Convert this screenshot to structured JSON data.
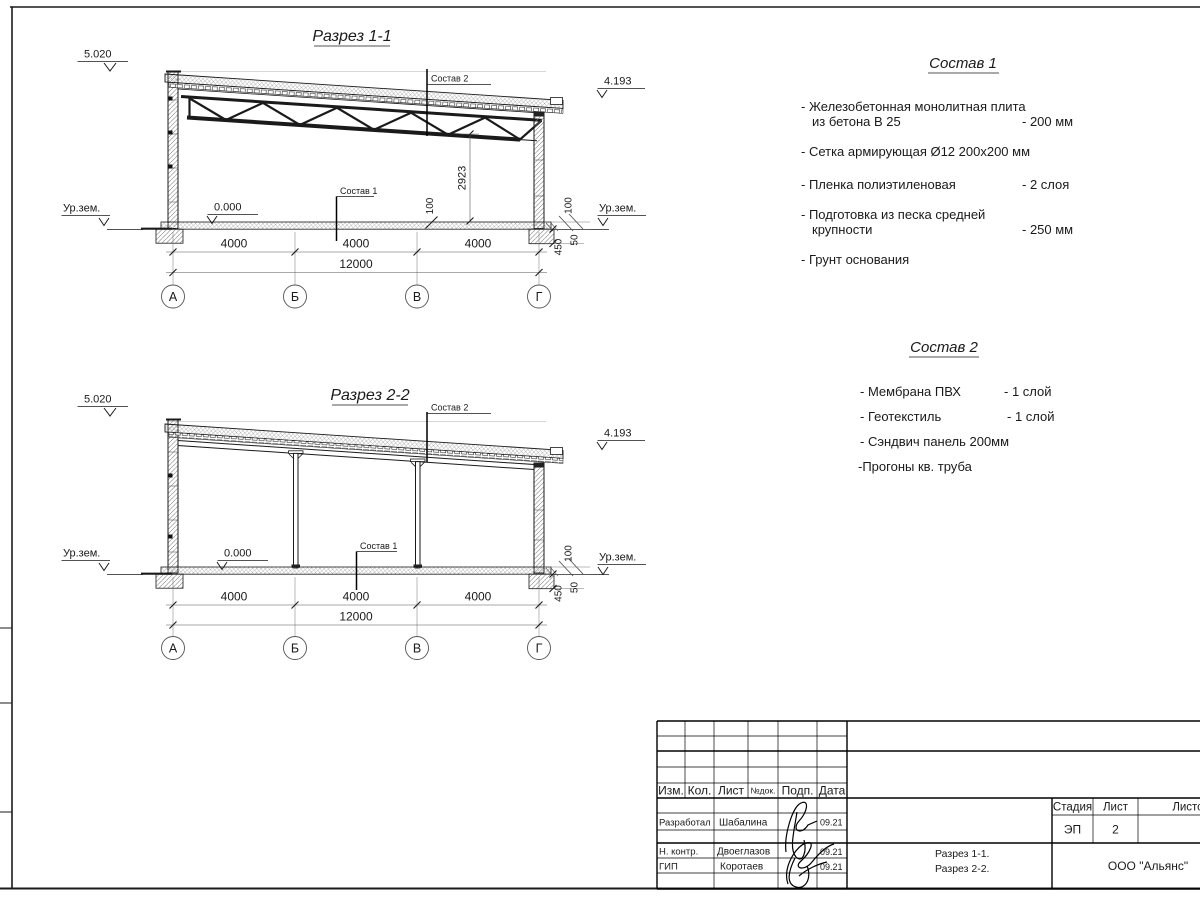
{
  "section1": {
    "title": "Разрез 1-1",
    "elev_top": "5.020",
    "elev_right": "4.193",
    "level_zero": "0.000",
    "ground_left": "Ур.зем.",
    "ground_right": "Ур.зем.",
    "leader_roof": "Состав 2",
    "leader_floor": "Состав 1",
    "dim_height": "2923",
    "dim_slab_mid": "100",
    "dim_100": "100",
    "dim_450": "450",
    "dim_50": "50",
    "dims": [
      "4000",
      "4000",
      "4000"
    ],
    "dim_total": "12000",
    "axes": [
      "А",
      "Б",
      "В",
      "Г"
    ]
  },
  "section2": {
    "title": "Разрез 2-2",
    "elev_top": "5.020",
    "elev_right": "4.193",
    "level_zero": "0.000",
    "ground_left": "Ур.зем.",
    "ground_right": "Ур.зем.",
    "leader_roof": "Состав 2",
    "leader_floor": "Состав 1",
    "dim_100": "100",
    "dim_450": "450",
    "dim_50": "50",
    "dims": [
      "4000",
      "4000",
      "4000"
    ],
    "dim_total": "12000",
    "axes": [
      "А",
      "Б",
      "В",
      "Г"
    ]
  },
  "sostav1": {
    "title": "Состав 1",
    "i1a": "- Железобетонная  монолитная плита",
    "i1b": "из бетона В 25",
    "i1v": "- 200 мм",
    "i2a": "- Сетка армирующая Ø12 200х200 мм",
    "i3a": "- Пленка полиэтиленовая",
    "i3v": "-  2 слоя",
    "i4a": "- Подготовка из песка средней",
    "i4b": "крупности",
    "i4v": "- 250 мм",
    "i5a": "- Грунт основания"
  },
  "sostav2": {
    "title": "Состав 2",
    "i1a": "- Мембрана ПВХ",
    "i1v": "- 1 слой",
    "i2a": "- Геотекстиль",
    "i2v": "- 1 слой",
    "i3a": "- Сэндвич панель 200мм",
    "i4a": "-Прогоны кв. труба"
  },
  "titleblock": {
    "h_izm": "Изм.",
    "h_kol": "Кол.",
    "h_list": "Лист",
    "h_doc": "№док.",
    "h_podp": "Подп.",
    "h_data": "Дата",
    "r1_role": "Разработал",
    "r1_name": "Шабалина",
    "r1_date": "09.21",
    "r2_role": "Н. контр.",
    "r2_name": "Двоеглазов",
    "r2_date": "09.21",
    "r3_role": "ГИП",
    "r3_name": "Коротаев",
    "r3_date": "09.21",
    "stage_h": "Стадия",
    "list_h": "Лист",
    "listov_h": "Листов",
    "stage": "ЭП",
    "list_num": "2",
    "doc1": "Разрез 1-1.",
    "doc2": "Разрез 2-2.",
    "company": "ООО \"Альянс\""
  }
}
